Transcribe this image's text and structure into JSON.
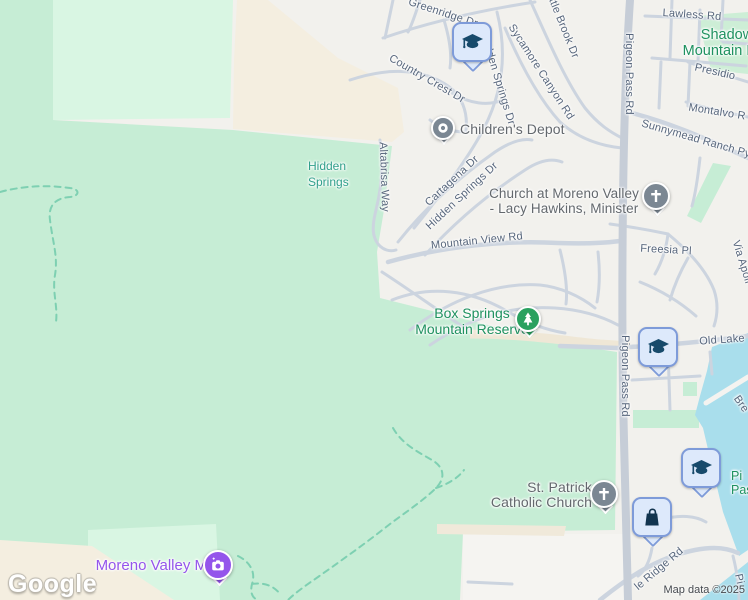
{
  "map": {
    "logo": "Google",
    "attribution": "Map data ©2025",
    "streets": {
      "greenridge": "Greenridge Dr",
      "little_brook": "Little Brook Dr",
      "lawless": "Lawless Rd",
      "presidio": "Presidio",
      "montalvo": "Montalvo R",
      "country_crest": "Country Crest Dr",
      "sycamore": "Sycamore Canyon Rd",
      "hidden_springs_n": "Hidden Springs Dr",
      "hidden_springs_s": "Hidden Springs Dr",
      "cartagena": "Cartagena Dr",
      "altabrisa": "Altabrisa Way",
      "pigeon_top": "Pigeon Pass Rd",
      "pigeon_mid": "Pigeon Pass Rd",
      "sunnymead": "Sunnymead Ranch Py",
      "mountain_view": "Mountain View Rd",
      "freesia": "Freesia Pl",
      "via_apollo": "Via Apoll",
      "old_lake": "Old Lake",
      "breezy": "Bre",
      "ridge": "le Ridge Rd",
      "pi_bottom": "Pi"
    },
    "places": {
      "childrens_depot": "Children's Depot",
      "church_moreno_line1": "Church at Moreno Valley",
      "church_moreno_line2": "- Lacy Hawkins, Minister",
      "shadow_line1": "Shadow",
      "shadow_line2": "Mountain Pas",
      "hidden_area_line1": "Hidden",
      "hidden_area_line2": "Springs",
      "box_springs_line1": "Box Springs",
      "box_springs_line2": "Mountain Reserve",
      "st_patrick_line1": "St. Patrick",
      "st_patrick_line2": "Catholic Church",
      "moreno_valley_m": "Moreno Valley M",
      "pigeon_pass_area_line1": "Pi",
      "pigeon_pass_area_line2": "Pass"
    },
    "icons": {
      "school": "graduation-cap-icon",
      "shopping": "shopping-bag-icon",
      "church": "cross-icon",
      "park": "tree-icon",
      "photo": "camera-icon",
      "generic_poi": "dot-icon"
    },
    "colors": {
      "background": "#f2f1ed",
      "park": "#c6edd5",
      "park_light": "#d9f6e3",
      "water": "#a9deec",
      "beige": "#f4eee0",
      "road": "#ccd4df",
      "street_label": "#57667c",
      "poi_label": "#63686d",
      "park_label": "#1e915f",
      "teal_label": "#32a08c",
      "purple": "#9455eb",
      "pin_blue_fill": "#dde9fb",
      "pin_blue_border": "#7e9bd9",
      "pin_glyph_navy": "#174a6b",
      "pin_gray": "#7b8793",
      "pin_green": "#2aa15f"
    }
  }
}
